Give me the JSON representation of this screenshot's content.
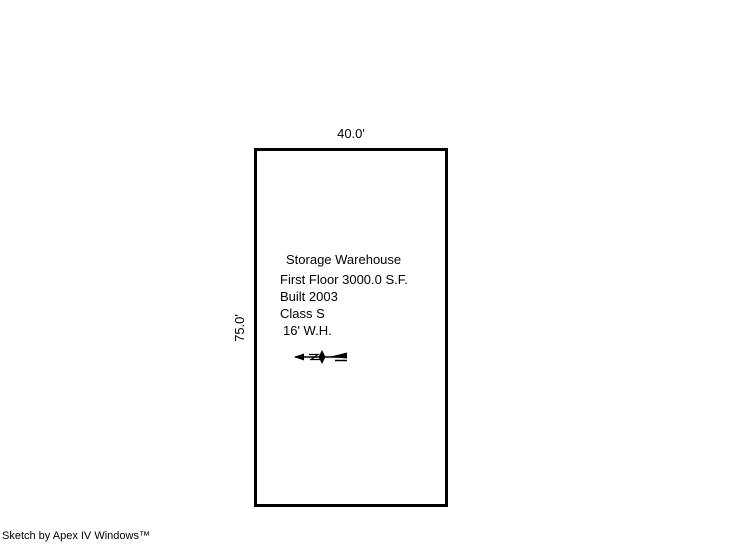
{
  "colors": {
    "background": "#ffffff",
    "line": "#000000",
    "text": "#000000"
  },
  "sketch": {
    "building": {
      "width_label": "40.0'",
      "height_label": "75.0'",
      "lines": [
        "Storage Warehouse",
        "First Floor 3000.0 S.F.",
        "Built 2003",
        "Class S",
        "16' W.H."
      ]
    },
    "icons": {
      "north_arrow": "north-arrow-compass-needle"
    },
    "credit": "Sketch by Apex IV Windows™"
  }
}
